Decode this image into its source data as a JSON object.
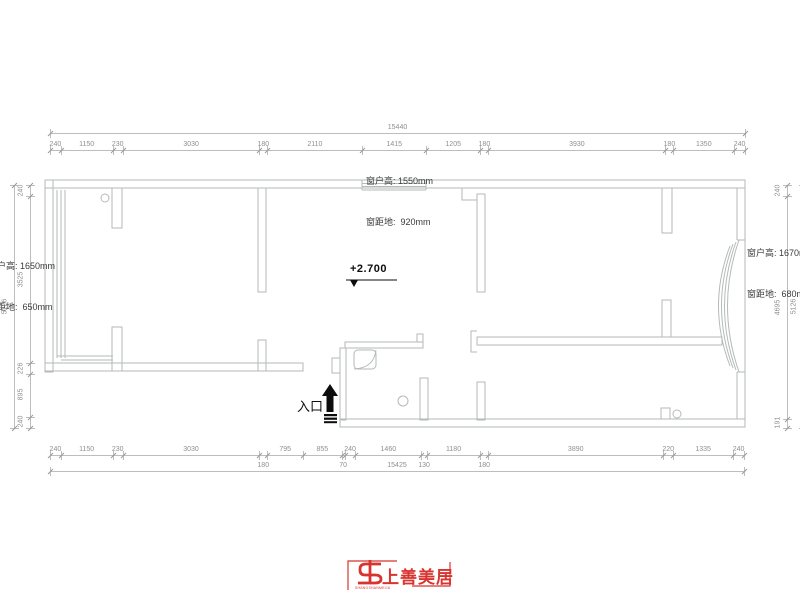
{
  "annotations": {
    "top_window": {
      "line1": "窗户高: 1550mm",
      "line2": "窗距地:  920mm"
    },
    "left_window": {
      "line1": "窗户高: 1650mm",
      "line2": "窗距地:  650mm"
    },
    "right_window": {
      "line1": "窗户高: 1670mm",
      "line2": "窗距地:  680mm"
    },
    "elevation": "+2.700",
    "entrance": "入口"
  },
  "logo": {
    "name": "上善美居",
    "subtext": "SHANGSHANMEIJU",
    "color": "#d8332f"
  },
  "colors": {
    "wall_line": "#b4bab8",
    "dim_line": "#bdbdbd",
    "dim_text": "#8f8f8f",
    "annotation_text": "#3a3a3a",
    "black": "#0d0d0d",
    "logo_red": "#d8332f"
  },
  "dimensions": {
    "top_overall": "15440",
    "bottom_overall": "15425",
    "left_overall": "5126",
    "right_overall": "5126"
  },
  "dim_chains": [
    {
      "id": "top-overall",
      "dir": "h",
      "x": 50,
      "y": 133,
      "len": 695,
      "segments": [
        {
          "v": "15440"
        }
      ]
    },
    {
      "id": "top-row",
      "dir": "h",
      "x": 50,
      "y": 150,
      "len": 695,
      "segments": [
        {
          "v": "240"
        },
        {
          "v": "1150"
        },
        {
          "v": "230"
        },
        {
          "v": "3030"
        },
        {
          "v": "180"
        },
        {
          "v": "2110"
        },
        {
          "v": "1415"
        },
        {
          "v": "1205"
        },
        {
          "v": "180"
        },
        {
          "v": "3930"
        },
        {
          "v": "180"
        },
        {
          "v": "1350"
        },
        {
          "v": "240"
        }
      ]
    },
    {
      "id": "bottom-row",
      "dir": "h",
      "x": 50,
      "y": 455,
      "len": 694,
      "segments": [
        {
          "v": "240"
        },
        {
          "v": "1150"
        },
        {
          "v": "230"
        },
        {
          "v": "3030"
        },
        {
          "v": "180",
          "drop": true
        },
        {
          "v": "795"
        },
        {
          "v": "855"
        },
        {
          "v": "70",
          "drop": true
        },
        {
          "v": "240"
        },
        {
          "v": "1460"
        },
        {
          "v": "130",
          "drop": true
        },
        {
          "v": "1180"
        },
        {
          "v": "180",
          "drop": true
        },
        {
          "v": "3890"
        },
        {
          "v": "220"
        },
        {
          "v": "1335"
        },
        {
          "v": "240"
        }
      ]
    },
    {
      "id": "bottom-overall",
      "dir": "h",
      "x": 50,
      "y": 471,
      "len": 694,
      "segments": [
        {
          "v": "15425"
        }
      ]
    },
    {
      "id": "left-row",
      "dir": "v",
      "x": 30,
      "y": 185,
      "len": 243,
      "segments": [
        {
          "v": "240"
        },
        {
          "v": "3525"
        },
        {
          "v": "226"
        },
        {
          "v": "895"
        },
        {
          "v": "240"
        }
      ]
    },
    {
      "id": "left-overall",
      "dir": "v",
      "x": 14,
      "y": 185,
      "len": 243,
      "segments": [
        {
          "v": "5126"
        }
      ]
    },
    {
      "id": "right-row",
      "dir": "v",
      "x": 787,
      "y": 185,
      "len": 243,
      "segments": [
        {
          "v": "240"
        },
        {
          "v": "4695"
        },
        {
          "v": "191"
        }
      ]
    },
    {
      "id": "right-overall",
      "dir": "v",
      "x": 803,
      "y": 185,
      "len": 243,
      "segments": [
        {
          "v": "5126"
        }
      ]
    }
  ]
}
